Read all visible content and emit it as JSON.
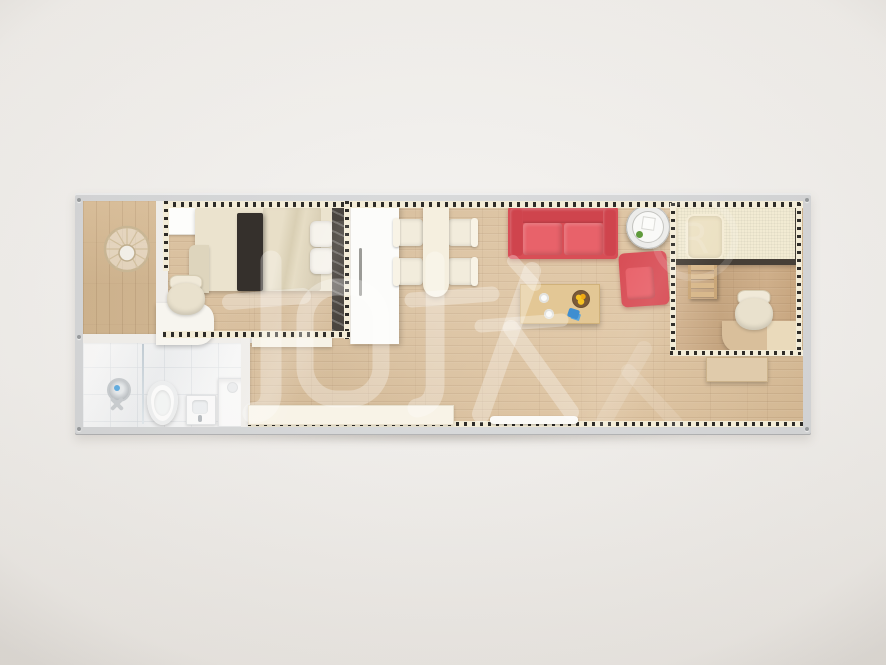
{
  "scene": {
    "type": "floor-plan-render",
    "description": "Top-down 3D render of a single-container tiny home floor plan on a plain light backdrop"
  },
  "watermark": {
    "text": "柜族",
    "registered_mark": "R",
    "color": "#ffffff"
  },
  "colors": {
    "backdrop": "#f1efec",
    "container_frame": "#d0d2d4",
    "wood_floor": "#d9b88c",
    "wood_floor_dark": "#c79e6f",
    "porch_wood": "#d4b284",
    "bathroom_tile": "#f4f5f6",
    "wall_cream": "#f3ecd7",
    "wall_dash": "#2e2c28",
    "sofa_red": "#d84e56",
    "bed_runner_dark": "#35302c",
    "coffee_table_wood": "#e3c795",
    "fruit_yellow": "#f2b718",
    "accent_blue": "#3e8ed0"
  },
  "rooms": [
    {
      "id": "entry-porch",
      "items": [
        "round-floor-decor"
      ]
    },
    {
      "id": "bathroom",
      "items": [
        "shower-head",
        "glass-screen",
        "toilet",
        "wash-basin",
        "washing-machine"
      ]
    },
    {
      "id": "bedroom",
      "items": [
        "nightstand",
        "double-bed",
        "bed-runner",
        "pillow",
        "pillow",
        "desk-chair",
        "desk",
        "mirror-panel",
        "wardrobe"
      ]
    },
    {
      "id": "dining-area",
      "items": [
        "dining-table",
        "dining-chair",
        "dining-chair",
        "dining-chair",
        "dining-chair"
      ]
    },
    {
      "id": "living-area",
      "items": [
        "sofa",
        "armchair",
        "round-side-table",
        "coffee-table",
        "fruit-bowl",
        "plates",
        "sideboard",
        "window-sill"
      ]
    },
    {
      "id": "study-bedroom",
      "items": [
        "single-bed",
        "pillow",
        "step-ladder",
        "desk-chair",
        "desk",
        "low-cabinet"
      ]
    }
  ]
}
